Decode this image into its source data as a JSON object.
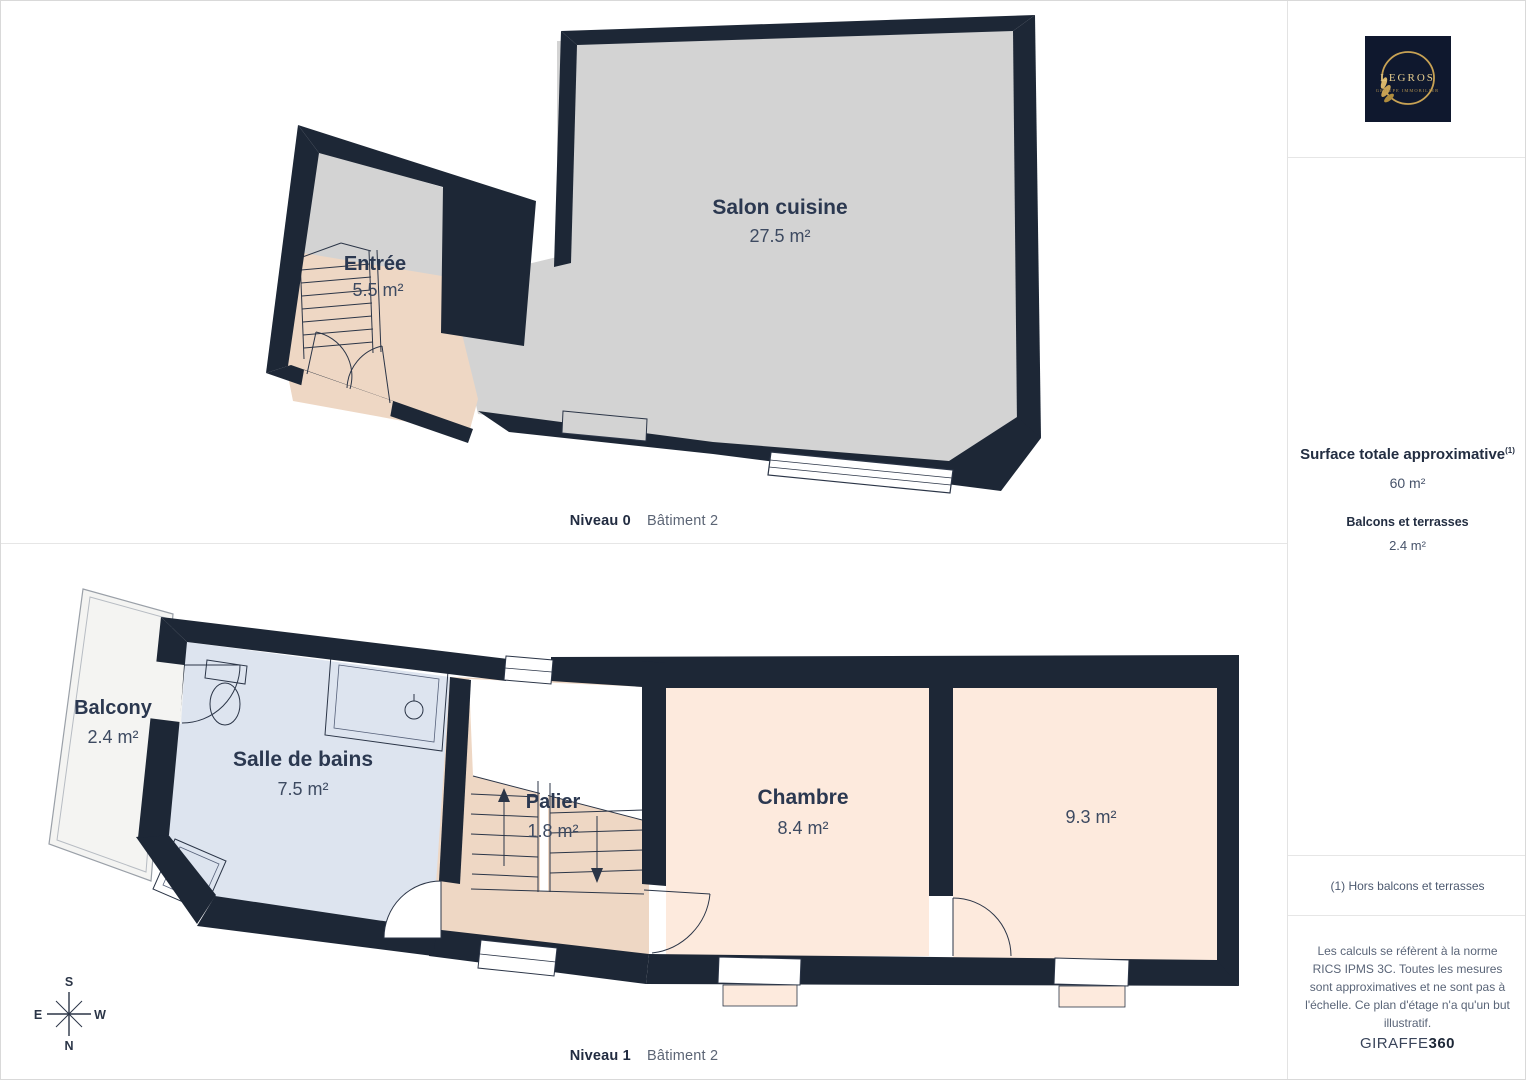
{
  "level0": {
    "caption": {
      "level": "Niveau 0",
      "building": "Bâtiment 2"
    },
    "rooms": {
      "salon": {
        "name": "Salon cuisine",
        "area": "27.5 m²"
      },
      "entree": {
        "name": "Entrée",
        "area": "5.5 m²"
      }
    }
  },
  "level1": {
    "caption": {
      "level": "Niveau 1",
      "building": "Bâtiment 2"
    },
    "rooms": {
      "balcony": {
        "name": "Balcony",
        "area": "2.4 m²"
      },
      "bathroom": {
        "name": "Salle de bains",
        "area": "7.5 m²"
      },
      "palier": {
        "name": "Palier",
        "area": "1.8 m²"
      },
      "chambre": {
        "name": "Chambre",
        "area": "8.4 m²"
      },
      "second": {
        "area": "9.3 m²"
      }
    }
  },
  "compass": {
    "n": "N",
    "s": "S",
    "e": "E",
    "w": "W"
  },
  "sidebar": {
    "logo": {
      "title": "LEGROS",
      "subtitle": "GROUPE IMMOBILIER"
    },
    "surface": {
      "title": "Surface totale approximative",
      "marker": "(1)",
      "value": "60 m²"
    },
    "balconies": {
      "title": "Balcons et terrasses",
      "value": "2.4 m²"
    },
    "footnote": "(1) Hors balcons et terrasses",
    "disclaimer": "Les calculs se réfèrent à la norme RICS IPMS 3C. Toutes les mesures sont approximatives et ne sont pas à l'échelle. Ce plan d'étage n'a qu'un but illustratif.",
    "brand": {
      "name": "GIRAFFE",
      "suffix": "360"
    }
  },
  "colors": {
    "wall": "#1d2736",
    "floor_gray": "#d3d3d3",
    "floor_peach": "#eed7c4",
    "floor_light_peach": "#fdeadd",
    "floor_blue": "#dde4ef",
    "balcony": "#f4f4f2",
    "gold": "#c8a254"
  }
}
